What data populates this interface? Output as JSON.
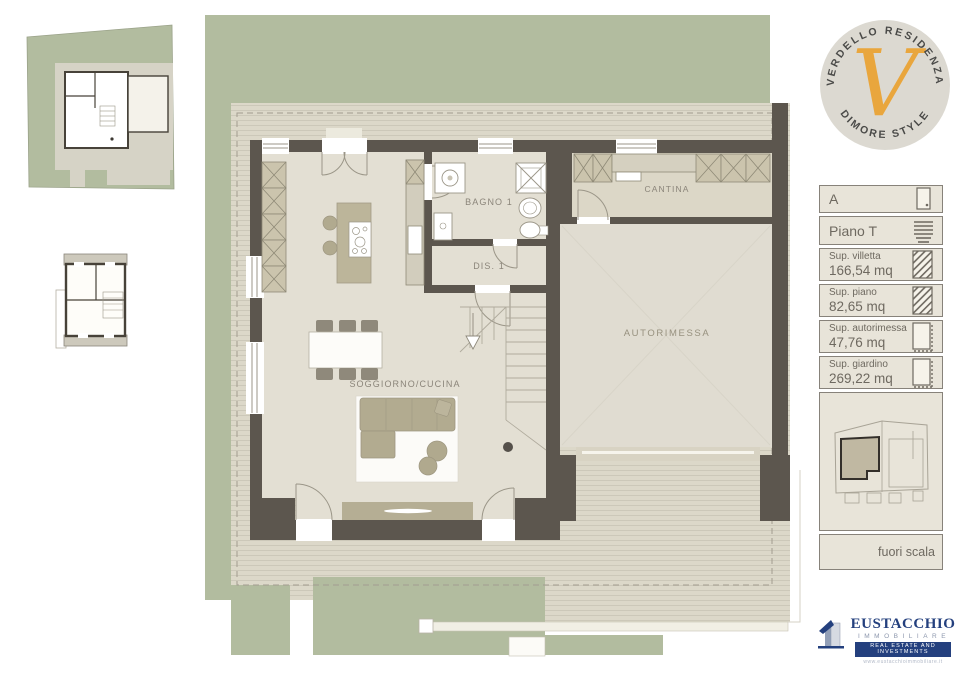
{
  "logo": {
    "arc_top": "VERDELLO RESIDENZA",
    "arc_bottom": "DIMORE STYLE",
    "monogram": "V"
  },
  "plan": {
    "labels": {
      "bagno": "BAGNO 1",
      "cantina": "CANTINA",
      "dis": "DIS. 1",
      "soggiorno": "SOGGIORNO/CUCINA",
      "autorimessa": "AUTORIMESSA"
    }
  },
  "legend": {
    "unit": "A",
    "floor": "Piano T",
    "entries": [
      {
        "label": "Sup. villetta",
        "value": "166,54 mq",
        "icon": "hatched-area-icon"
      },
      {
        "label": "Sup. piano",
        "value": "82,65 mq",
        "icon": "hatched-area-icon"
      },
      {
        "label": "Sup. autorimessa",
        "value": "47,76 mq",
        "icon": "outline-area-icon"
      },
      {
        "label": "Sup. giardino",
        "value": "269,22 mq",
        "icon": "outline-area-icon"
      }
    ],
    "scale_note": "fuori scala"
  },
  "brand": {
    "name": "EUSTACCHIO",
    "division": "IMMOBILIARE",
    "tagline": "REAL ESTATE AND INVESTMENTS",
    "website": "www.eustacchioimmobiliare.it"
  },
  "colors": {
    "wall": "#5c564e",
    "floor": "#e3dfd3",
    "floor_cantina": "#dcd7c7",
    "floor_garage": "#e0dcd1",
    "garden": "#b2bc9f",
    "paving": "#dcd8c9",
    "paving_line": "#ccc8b9",
    "hatch": "#cbc4ad",
    "furniture": "#bcb59a",
    "accent": "#e9a63d",
    "legend_bg": "#e8e4d9",
    "legend_border": "#87827a",
    "brand_blue": "#24407e",
    "text_muted": "#8b857a"
  }
}
